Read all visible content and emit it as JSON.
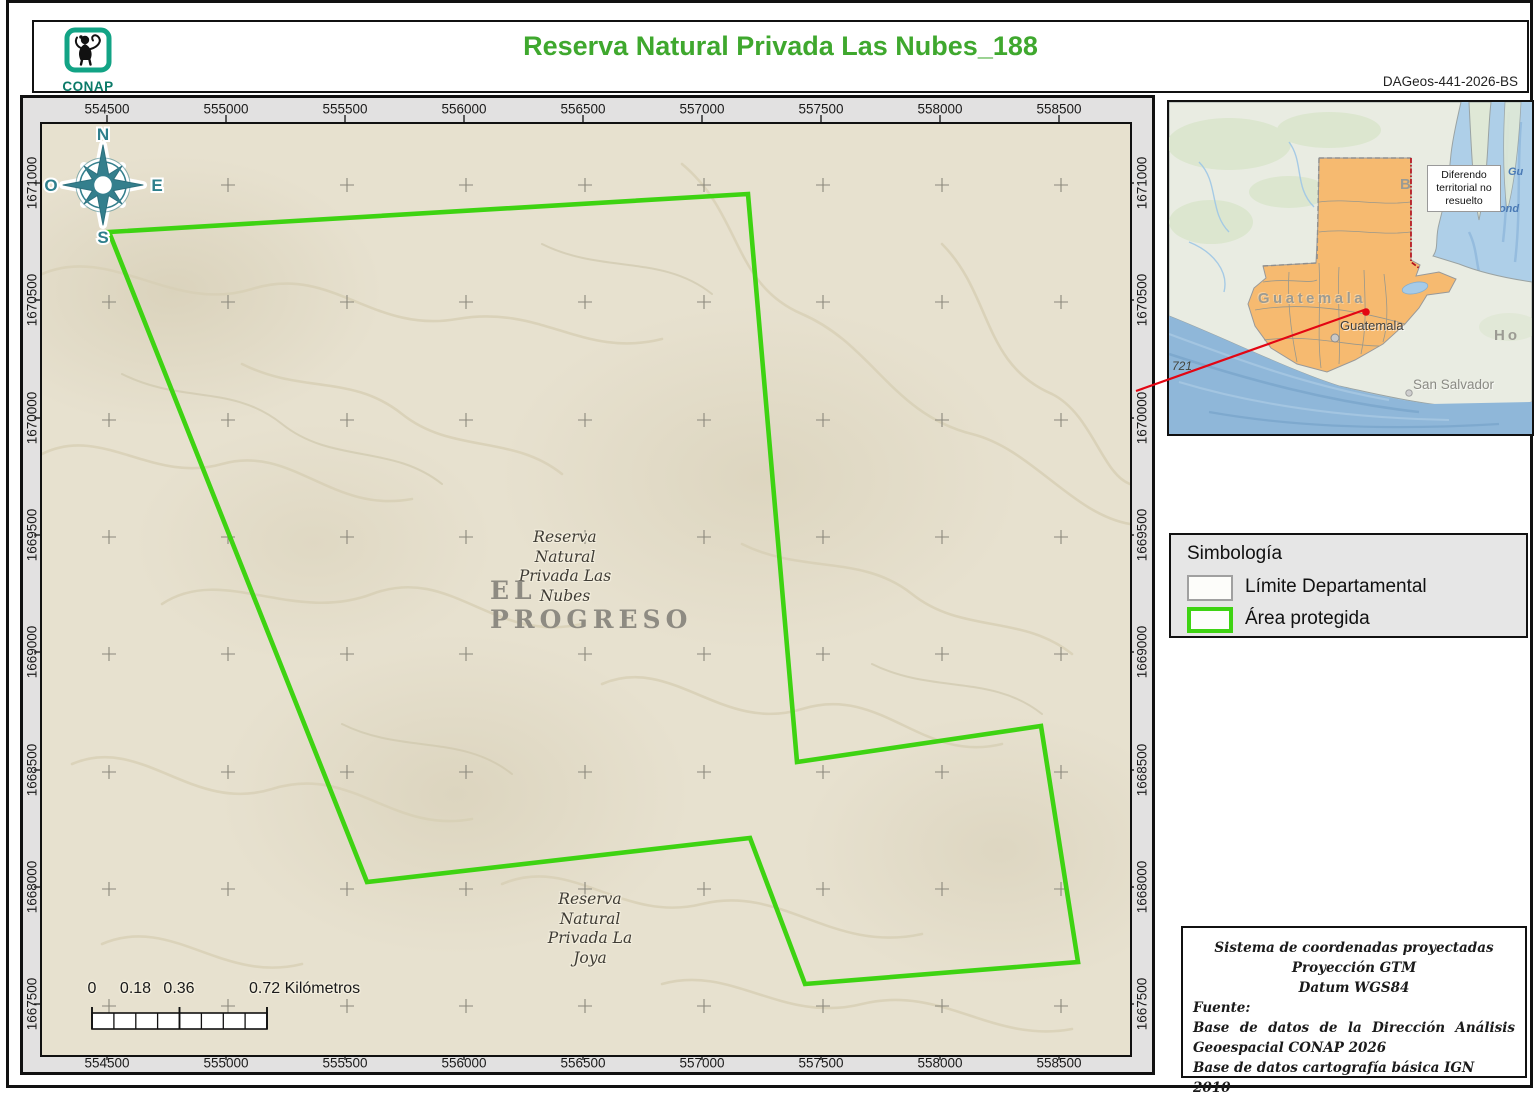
{
  "header": {
    "logo_text": "CONAP",
    "title": "Reserva Natural Privada Las Nubes_188",
    "doc_code": "DAGeos-441-2026-BS"
  },
  "map": {
    "x_ticks": [
      "554500",
      "555000",
      "555500",
      "556000",
      "556500",
      "557000",
      "557500",
      "558000",
      "558500"
    ],
    "y_ticks": [
      "1671000",
      "1670500",
      "1670000",
      "1669500",
      "1669000",
      "1668500",
      "1668000",
      "1667500"
    ],
    "compass": {
      "north": "N",
      "south": "S",
      "east": "E",
      "west": "O"
    },
    "labels": {
      "reserve_main": "Reserva\nNatural\nPrivada Las\nNubes",
      "department": "EL PROGRESO",
      "reserve_secondary": "Reserva\nNatural\nPrivada La\nJoya"
    },
    "scalebar": {
      "tick_labels": [
        "0",
        "0.18",
        "0.36"
      ],
      "end_label": "0.72 Kilómetros"
    }
  },
  "inset": {
    "country_label": "Guatemala",
    "city_label": "Guatemala",
    "san_salvador_label": "San Salvador",
    "honduras_fragment": "Ho",
    "belize_fragment": "B",
    "sea_fragment_1": "Gu",
    "sea_fragment_2": "Hond",
    "road_label": "721",
    "note_box": "Diferendo\nterritorial no\nresuelto"
  },
  "legend": {
    "title": "Simbología",
    "items": [
      {
        "label": "Límite Departamental"
      },
      {
        "label": "Área protegida"
      }
    ]
  },
  "info_box": {
    "lines_centered": [
      "Sistema de coordenadas proyectadas",
      "Proyección GTM",
      "Datum WGS84"
    ],
    "fuente_label": "Fuente:",
    "sources": [
      "Base de datos de la Dirección Análisis Geoespacial CONAP 2026",
      "Base de datos cartografía básica IGN 2010"
    ]
  },
  "colors": {
    "protected_area_green": "#3ed312",
    "title_green": "#3fa82e",
    "compass_teal": "#2e7f8c",
    "guatemala_orange": "#f6ba70",
    "locator_red": "#e30613",
    "map_background": "#e7e1cf"
  }
}
